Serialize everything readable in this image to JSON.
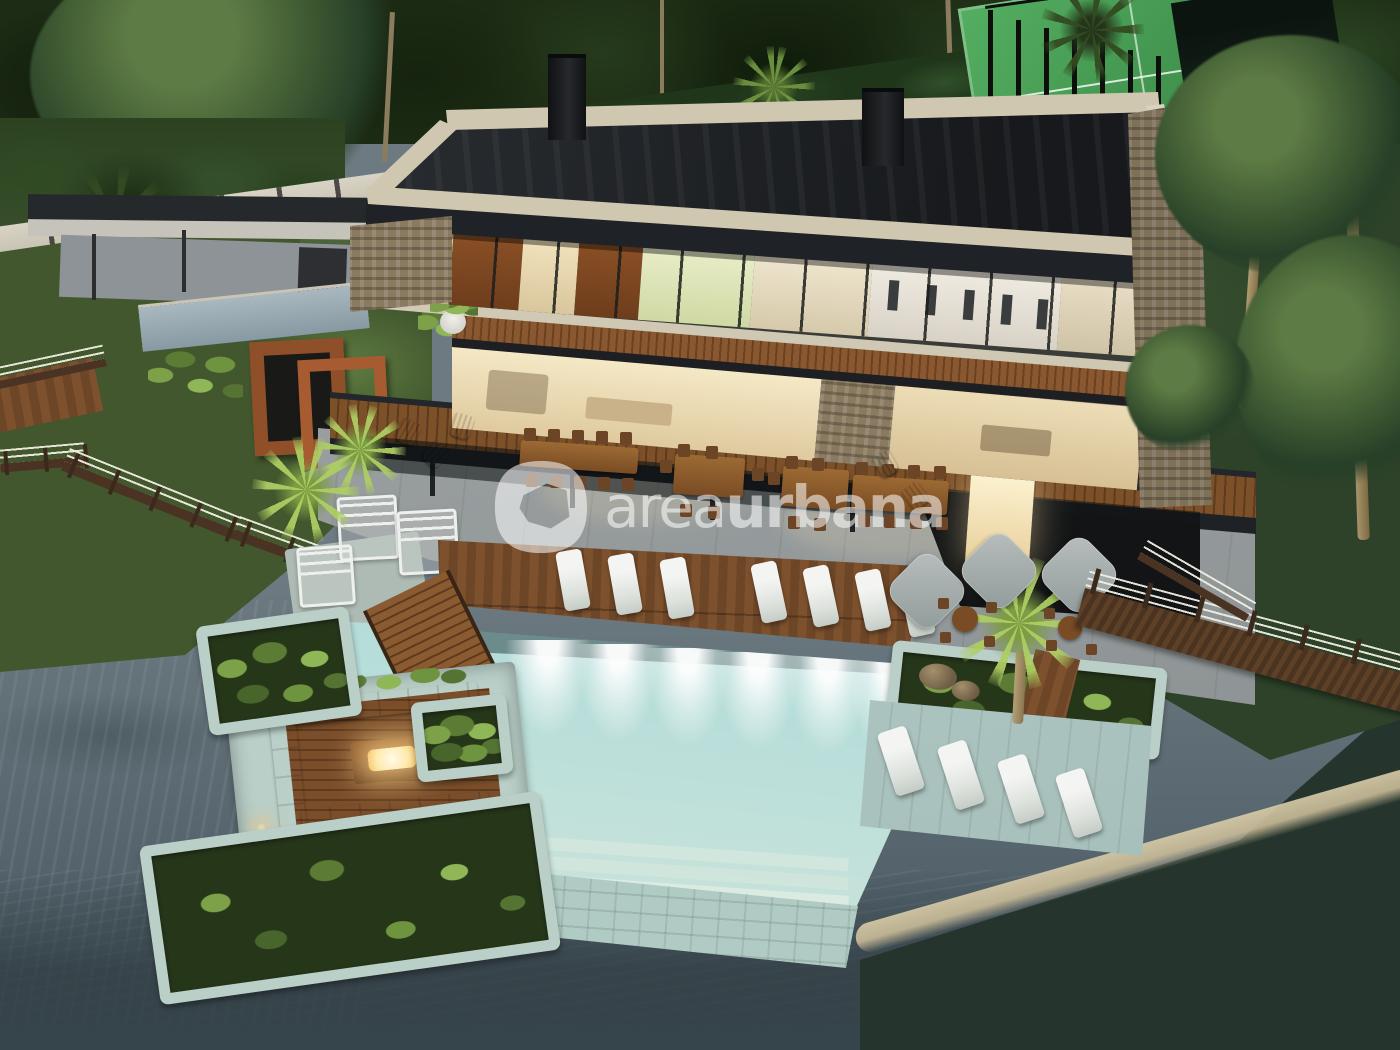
{
  "image": {
    "type": "3d-architectural-rendering",
    "subject": "Modern three-storey lakefront villa at dusk with infinity pool",
    "view": "aerial"
  },
  "watermark": {
    "logo": "areaurbana-logo",
    "text_light": "area",
    "text_bold": "urbana",
    "color": "#ffffff",
    "opacity": 0.55
  },
  "palette": {
    "foliage": "#1d2c14",
    "canopy": "#3f5b30",
    "lawn": "#42572e",
    "court": "#44a052",
    "road": "#7b8184",
    "wall": "#cfc9ba",
    "stone": "#8a7a60",
    "roof": "#24272b",
    "fascia": "#1f2226",
    "cream": "#cfc7b0",
    "wood": "#7a4e2a",
    "wooddark": "#5d3b1f",
    "glass": "#f0e2c0",
    "glow": "#ffedbe",
    "patio": "#9aa0a0",
    "pool": "#a9d4d8",
    "poolwall": "#b2ccc6",
    "planter": "#b9cfc8",
    "waterslate": "#68767f",
    "waterdark": "#3d4d52",
    "watergreen": "#2d4034",
    "sand": "#c9bb97",
    "furniture": "#eef0ee"
  },
  "scene": {
    "environment": {
      "lake": true,
      "access_road": true,
      "sports_court": true,
      "boardwalk_rope_fence": true,
      "palm_trees": 6,
      "large_trees": 3
    },
    "villa": {
      "storeys": 3,
      "roof": "flat roof terrace with two black chimneys and cream parapet",
      "top_floor": "bedrooms behind glass with rust wood panels and planted balcony",
      "middle_floor": "lit living-dining room behind full-height glass with wood brise-soleil",
      "ground_floor": "covered terrace with dining tables",
      "stone_columns": 2
    },
    "pool_area": {
      "underwater_lights": 6,
      "deck_sun_loungers": 7,
      "ledge_sun_loungers": 4,
      "wooden_bridge": true,
      "sunken_fire_lounge": {
        "sofas": "white U-shaped",
        "fire_table": 1
      },
      "planters": 5,
      "parasols": 3,
      "outdoor_tables": 4,
      "adirondack_chairs": 5,
      "daybeds": 3
    }
  }
}
